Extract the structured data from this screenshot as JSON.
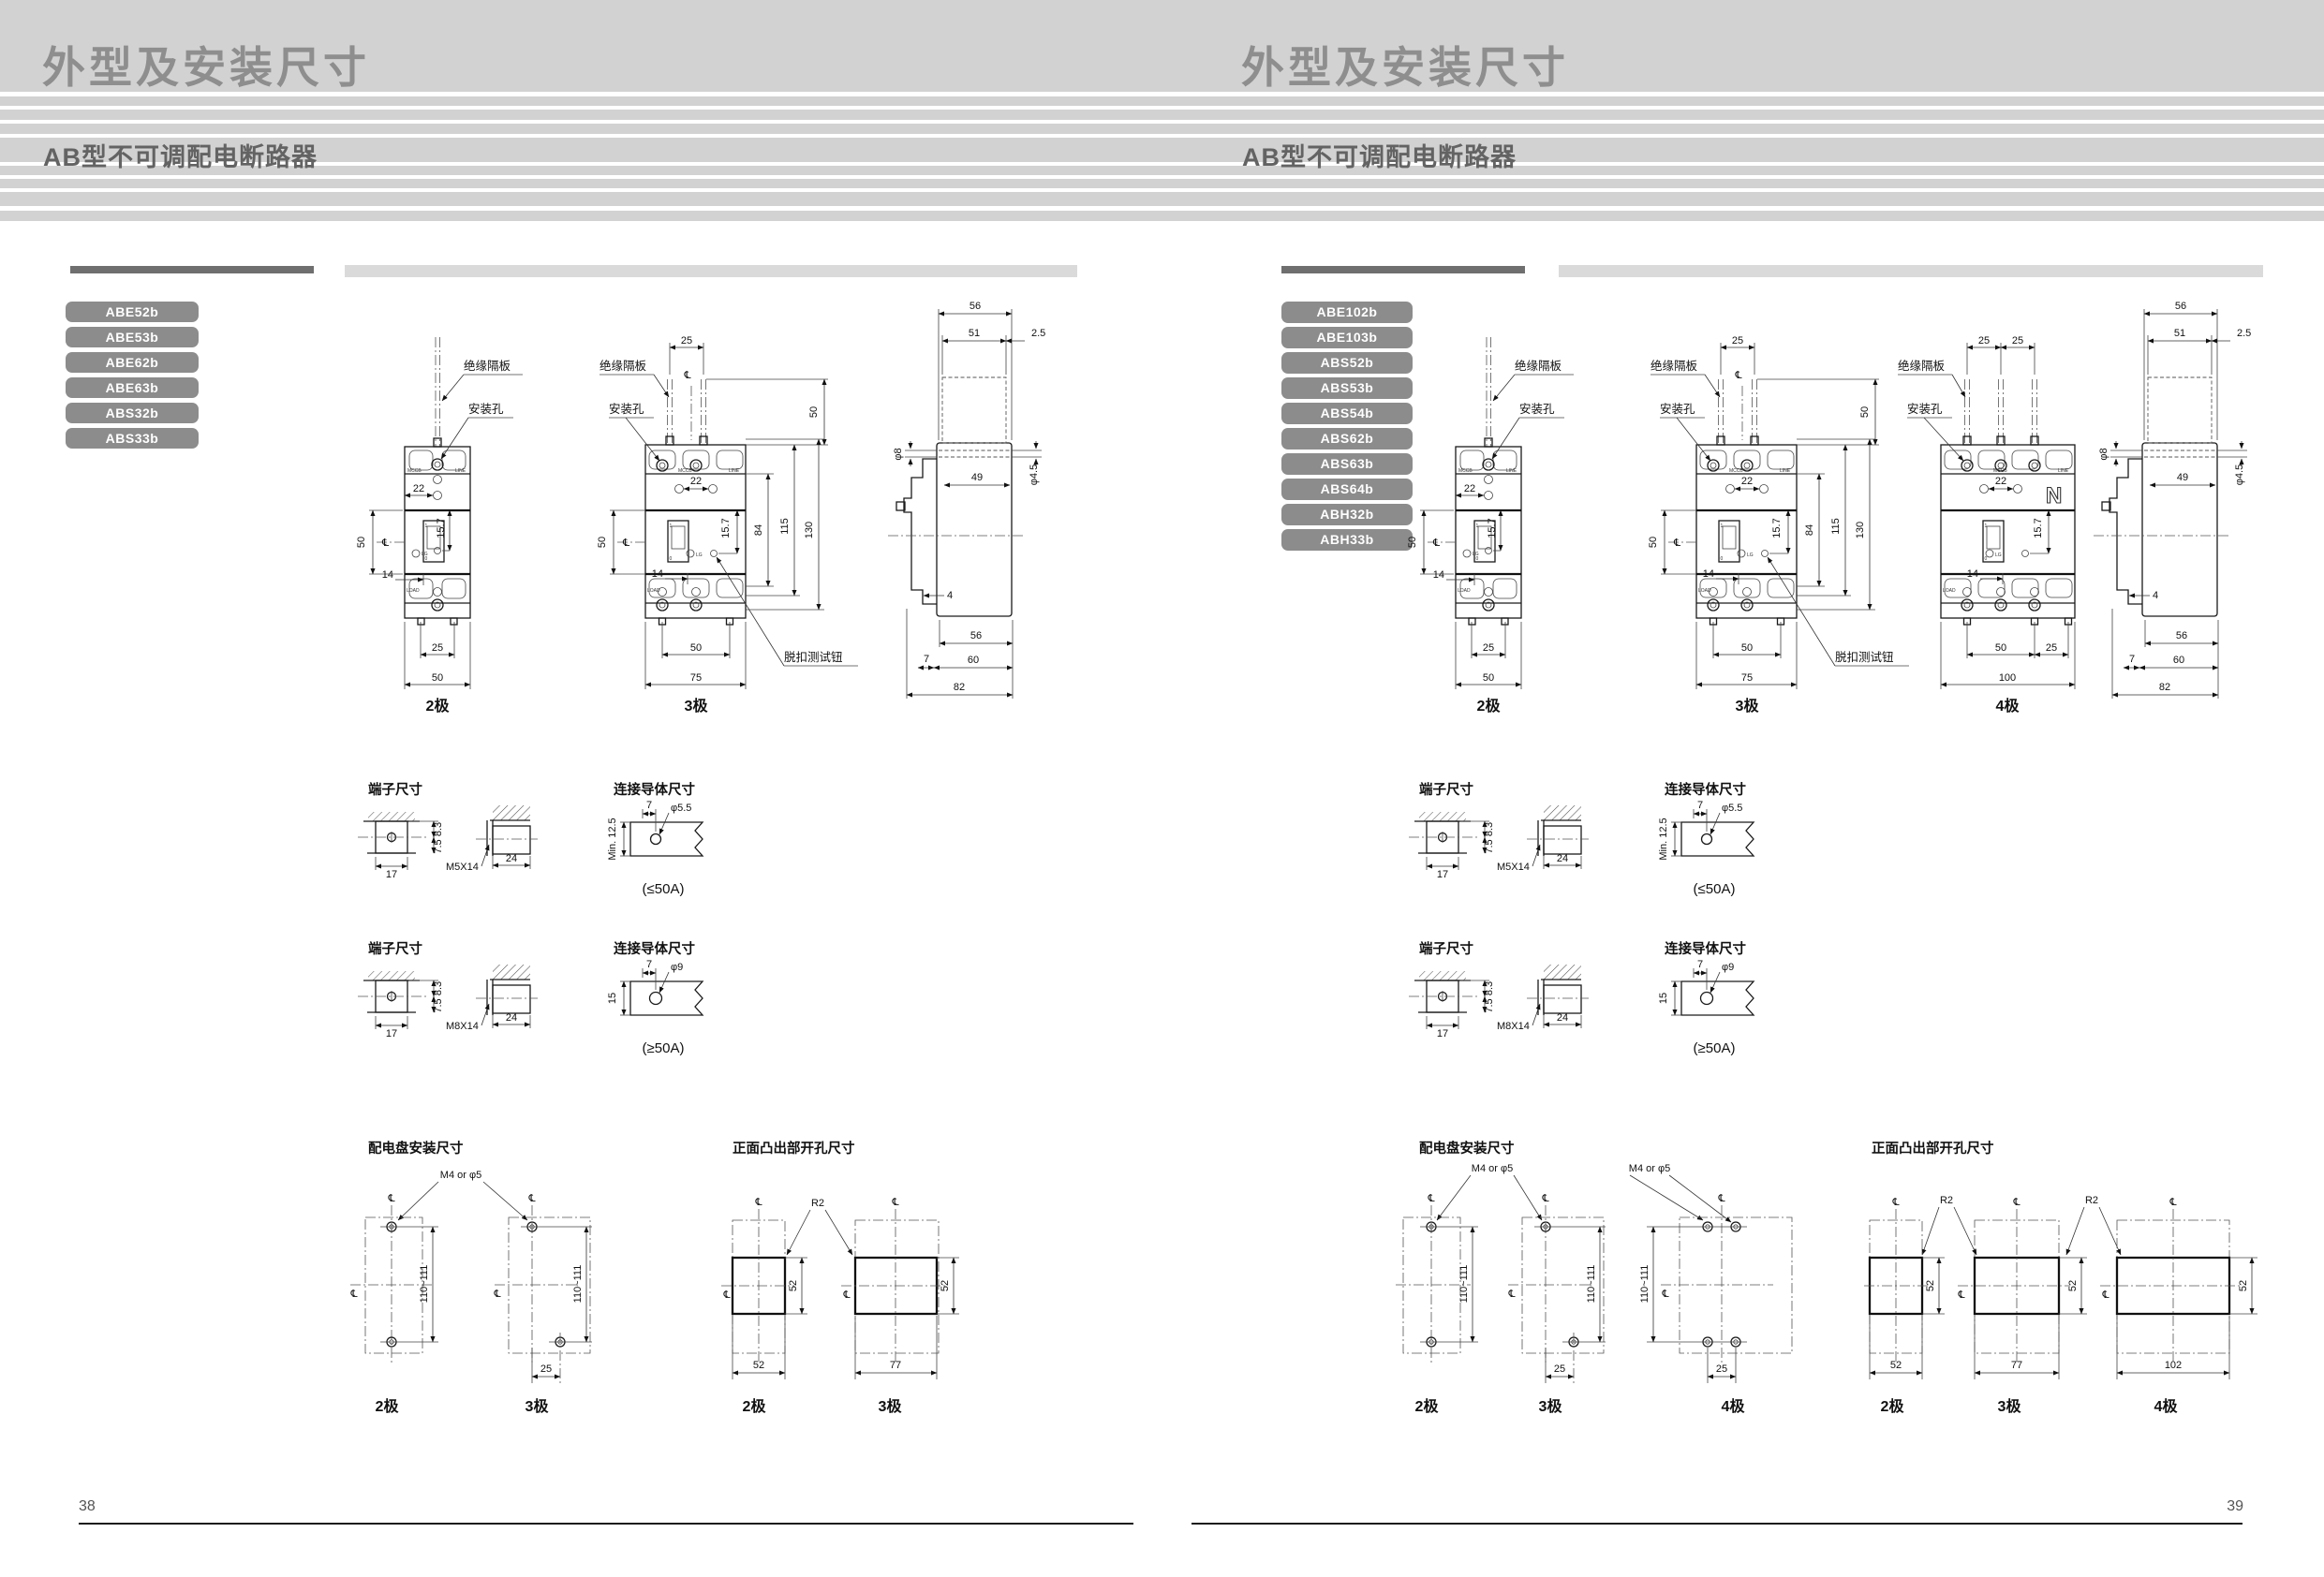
{
  "colors": {
    "header_bg": "#d2d2d2",
    "badge_bg": "#8c8c8c",
    "title_text": "#8e8e8e",
    "subtitle_text": "#636363"
  },
  "pages": {
    "left": {
      "title": "外型及安装尺寸",
      "subtitle": "AB型不可调配电断路器",
      "page_number": "38",
      "models": [
        "ABE52b",
        "ABE53b",
        "ABE62b",
        "ABE63b",
        "ABS32b",
        "ABS33b"
      ],
      "labels": {
        "insulation": "绝缘隔板",
        "mount_hole": "安装孔",
        "trip_test": "脱扣测试钮",
        "centerline": "℄"
      },
      "face": {
        "mccb": "MCCB",
        "line": "LINE",
        "load": "LOAD",
        "brand": "LG",
        "on": "1",
        "off": "0"
      },
      "front2": {
        "caption": "2极",
        "w_top": "22",
        "h_left": "50",
        "handle_offset": "15.7",
        "off": "14",
        "w_mid": "25",
        "w_bot": "50"
      },
      "front3": {
        "caption": "3极",
        "gap_top": "25",
        "h_barrier": "50",
        "w_top": "22",
        "handle_offset": "15.7",
        "h1": "84",
        "h2": "115",
        "h3": "130",
        "h_left": "50",
        "off": "14",
        "w_mid": "50",
        "w_bot": "75"
      },
      "side": {
        "w1": "56",
        "w2": "51",
        "w3": "2.5",
        "hole_top": "φ8",
        "w4": "49",
        "hole_front": "φ4.5",
        "t1": "4",
        "t2": "7",
        "b1": "56",
        "b2": "60",
        "b3": "82"
      },
      "terminals": [
        {
          "title": "端子尺寸",
          "w": "17",
          "h1": "8.3",
          "h2": "7.5",
          "screw": "M5X14",
          "depth": "24",
          "cond_title": "连接导体尺寸",
          "off": "7",
          "hole": "φ5.5",
          "min_w": "Min. 12.5",
          "rating": "(≤50A)"
        },
        {
          "title": "端子尺寸",
          "w": "17",
          "h1": "8.3",
          "h2": "7.5",
          "screw": "M8X14",
          "depth": "24",
          "cond_title": "连接导体尺寸",
          "off": "7",
          "hole": "φ9",
          "min_w": "15",
          "rating": "(≥50A)"
        }
      ],
      "panel": {
        "title": "配电盘安装尺寸",
        "screw": "M4 or φ5",
        "pitch": "110~111",
        "offset": "25",
        "cap2": "2极",
        "cap3": "3极"
      },
      "cutout": {
        "title": "正面凸出部开孔尺寸",
        "radius": "R2",
        "height": "52",
        "w2": "52",
        "w3": "77",
        "cap2": "2极",
        "cap3": "3极"
      }
    },
    "right": {
      "title": "外型及安装尺寸",
      "subtitle": "AB型不可调配电断路器",
      "page_number": "39",
      "models": [
        "ABE102b",
        "ABE103b",
        "ABS52b",
        "ABS53b",
        "ABS54b",
        "ABS62b",
        "ABS63b",
        "ABS64b",
        "ABH32b",
        "ABH33b"
      ],
      "labels": {
        "insulation": "绝缘隔板",
        "mount_hole": "安装孔",
        "trip_test": "脱扣测试钮",
        "centerline": "℄"
      },
      "face": {
        "mccb": "MCCB",
        "line": "LINE",
        "load": "LOAD",
        "brand": "LG",
        "on": "1",
        "off": "0"
      },
      "front2": {
        "caption": "2极",
        "w_top": "22",
        "h_left": "50",
        "handle_offset": "15.7",
        "off": "14",
        "w_mid": "25",
        "w_bot": "50"
      },
      "front3": {
        "caption": "3极",
        "gap_top": "25",
        "h_barrier": "50",
        "w_top": "22",
        "handle_offset": "15.7",
        "h1": "84",
        "h2": "115",
        "h3": "130",
        "h_left": "50",
        "off": "14",
        "w_mid": "50",
        "w_bot": "75"
      },
      "front4": {
        "caption": "4极",
        "gap1": "25",
        "gap2": "25",
        "w_top": "22",
        "handle_offset": "15.7",
        "off": "14",
        "w_mid": "50",
        "w_mid2": "25",
        "w_bot": "100",
        "neutral": "N"
      },
      "side": {
        "w1": "56",
        "w2": "51",
        "w3": "2.5",
        "hole_top": "φ8",
        "w4": "49",
        "hole_front": "φ4.5",
        "t1": "4",
        "t2": "7",
        "b1": "56",
        "b2": "60",
        "b3": "82"
      },
      "terminals": [
        {
          "title": "端子尺寸",
          "w": "17",
          "h1": "8.3",
          "h2": "7.5",
          "screw": "M5X14",
          "depth": "24",
          "cond_title": "连接导体尺寸",
          "off": "7",
          "hole": "φ5.5",
          "min_w": "Min. 12.5",
          "rating": "(≤50A)"
        },
        {
          "title": "端子尺寸",
          "w": "17",
          "h1": "8.3",
          "h2": "7.5",
          "screw": "M8X14",
          "depth": "24",
          "cond_title": "连接导体尺寸",
          "off": "7",
          "hole": "φ9",
          "min_w": "15",
          "rating": "(≥50A)"
        }
      ],
      "panel": {
        "title": "配电盘安装尺寸",
        "screw": "M4 or φ5",
        "screw2": "M4 or φ5",
        "pitch": "110~111",
        "offset": "25",
        "offset2": "25",
        "cap2": "2极",
        "cap3": "3极",
        "cap4": "4极"
      },
      "cutout": {
        "title": "正面凸出部开孔尺寸",
        "radius": "R2",
        "radius2": "R2",
        "height": "52",
        "w2": "52",
        "w3": "77",
        "w4": "102",
        "cap2": "2极",
        "cap3": "3极",
        "cap4": "4极"
      }
    }
  }
}
